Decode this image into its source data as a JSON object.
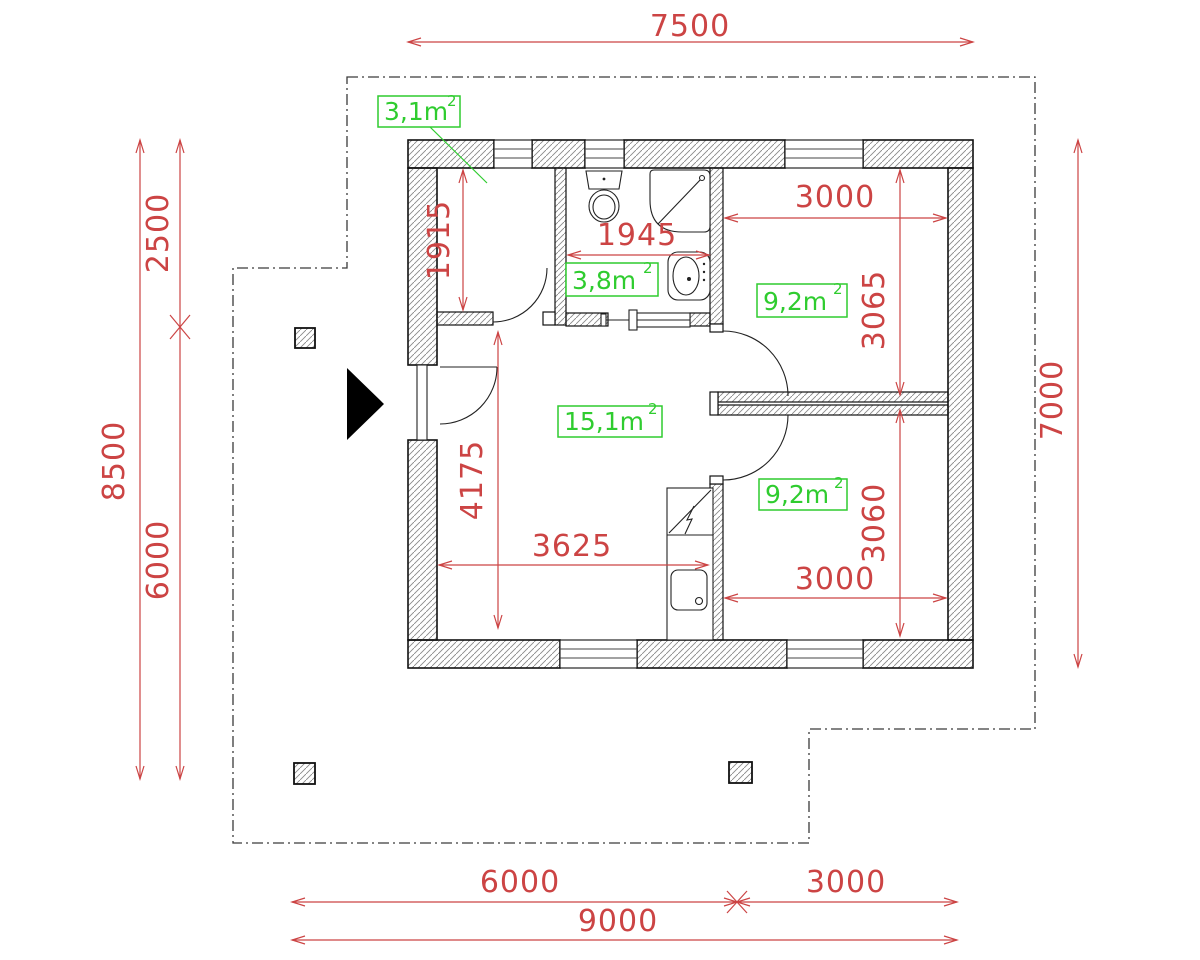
{
  "drawing": {
    "title": "house-floor-plan",
    "colors": {
      "dimension_red": "#cc4444",
      "area_green": "#2fcc2f",
      "wall_black": "#111111",
      "boundary_gray": "#3a3a3a"
    },
    "area_labels": [
      {
        "room": "storage",
        "value": "3,1m",
        "sup": "2"
      },
      {
        "room": "bathroom",
        "value": "3,8m",
        "sup": "2"
      },
      {
        "room": "living",
        "value": "15,1m",
        "sup": "2"
      },
      {
        "room": "bedroom-1",
        "value": "9,2m",
        "sup": "2"
      },
      {
        "room": "bedroom-2",
        "value": "9,2m",
        "sup": "2"
      }
    ],
    "dimensions": {
      "top_width": "7500",
      "left_total": "8500",
      "left_upper": "2500",
      "left_lower": "6000",
      "right_height": "7000",
      "bottom_left": "6000",
      "bottom_right": "3000",
      "bottom_total": "9000",
      "storage_height": "1915",
      "bathroom_width": "1945",
      "bedroom1_width": "3000",
      "bedroom1_height": "3065",
      "bedroom2_width": "3000",
      "bedroom2_height": "3060",
      "living_width": "3625",
      "living_height": "4175"
    }
  }
}
